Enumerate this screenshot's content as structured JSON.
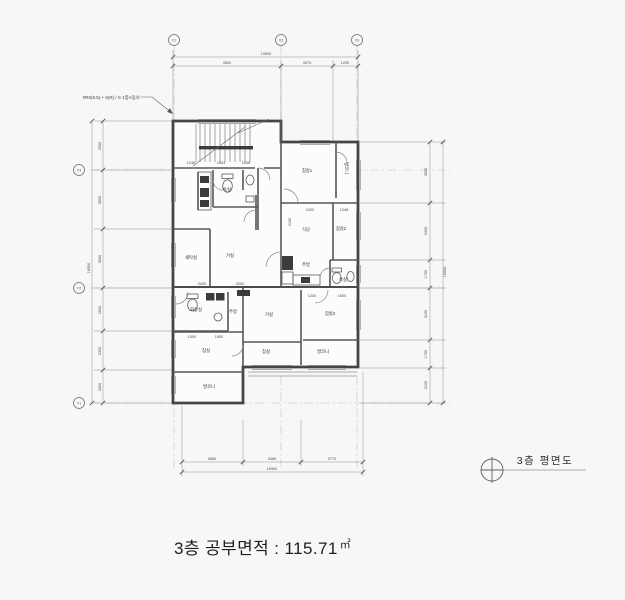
{
  "drawing": {
    "note": "#R6(8.5) + 6(R) / S 1종A동보",
    "plan_title": "3층 평면도",
    "caption_label": "3층 공부면적 : 115.71",
    "caption_unit": "㎡",
    "grid": {
      "x_axes": [
        {
          "label": "X1",
          "x": 174
        },
        {
          "label": "X2",
          "x": 281
        },
        {
          "label": "X3",
          "x": 357
        }
      ],
      "y_axes": [
        {
          "label": "Y3",
          "y": 170
        },
        {
          "label": "Y2",
          "y": 288
        },
        {
          "label": "Y1",
          "y": 403
        }
      ]
    },
    "room_labels": [
      {
        "t": "욕실",
        "x": 227,
        "y": 191
      },
      {
        "t": "침실1",
        "x": 307,
        "y": 172
      },
      {
        "t": "발코니",
        "x": 345,
        "y": 168,
        "v": 1
      },
      {
        "t": "세탁실",
        "x": 191,
        "y": 259
      },
      {
        "t": "거실",
        "x": 230,
        "y": 257
      },
      {
        "t": "식당",
        "x": 306,
        "y": 231
      },
      {
        "t": "침실2",
        "x": 341,
        "y": 230
      },
      {
        "t": "주방",
        "x": 306,
        "y": 266
      },
      {
        "t": "욕실",
        "x": 343,
        "y": 281
      },
      {
        "t": "화장실",
        "x": 196,
        "y": 311
      },
      {
        "t": "주방",
        "x": 233,
        "y": 313
      },
      {
        "t": "거실",
        "x": 269,
        "y": 316
      },
      {
        "t": "침실3",
        "x": 330,
        "y": 315
      },
      {
        "t": "침실",
        "x": 266,
        "y": 353
      },
      {
        "t": "발코니",
        "x": 323,
        "y": 353
      },
      {
        "t": "침실",
        "x": 206,
        "y": 352
      },
      {
        "t": "발코니",
        "x": 209,
        "y": 388
      }
    ],
    "dim_labels": [
      {
        "t": "10900",
        "x": 266,
        "y": 55
      },
      {
        "t": "4500",
        "x": 227,
        "y": 64
      },
      {
        "t": "4070",
        "x": 307,
        "y": 64
      },
      {
        "t": "1200",
        "x": 345,
        "y": 64
      },
      {
        "t": "3650",
        "x": 212,
        "y": 460
      },
      {
        "t": "3480",
        "x": 272,
        "y": 460
      },
      {
        "t": "3770",
        "x": 332,
        "y": 460
      },
      {
        "t": "10900",
        "x": 272,
        "y": 470
      },
      {
        "t": "16900",
        "x": 90,
        "y": 268,
        "r": 1
      },
      {
        "t": "2900",
        "x": 101,
        "y": 146,
        "r": 1
      },
      {
        "t": "3500",
        "x": 101,
        "y": 200,
        "r": 1
      },
      {
        "t": "3500",
        "x": 101,
        "y": 259,
        "r": 1
      },
      {
        "t": "2600",
        "x": 101,
        "y": 310,
        "r": 1
      },
      {
        "t": "2300",
        "x": 101,
        "y": 351,
        "r": 1
      },
      {
        "t": "2000",
        "x": 101,
        "y": 387,
        "r": 1
      },
      {
        "t": "15600",
        "x": 446,
        "y": 272,
        "r": 1
      },
      {
        "t": "3650",
        "x": 427,
        "y": 172,
        "r": 1
      },
      {
        "t": "3400",
        "x": 427,
        "y": 231,
        "r": 1
      },
      {
        "t": "1700",
        "x": 427,
        "y": 274,
        "r": 1
      },
      {
        "t": "3100",
        "x": 427,
        "y": 314,
        "r": 1
      },
      {
        "t": "1700",
        "x": 427,
        "y": 354,
        "r": 1
      },
      {
        "t": "2100",
        "x": 427,
        "y": 385,
        "r": 1
      },
      {
        "t": "1248",
        "x": 191,
        "y": 164
      },
      {
        "t": "1803",
        "x": 221,
        "y": 164
      },
      {
        "t": "1508",
        "x": 246,
        "y": 164
      },
      {
        "t": "2400",
        "x": 310,
        "y": 211
      },
      {
        "t": "1248",
        "x": 344,
        "y": 211
      },
      {
        "t": "2400",
        "x": 202,
        "y": 285
      },
      {
        "t": "3200",
        "x": 240,
        "y": 285
      },
      {
        "t": "1200",
        "x": 312,
        "y": 297
      },
      {
        "t": "1500",
        "x": 342,
        "y": 297
      },
      {
        "t": "1500",
        "x": 192,
        "y": 338
      },
      {
        "t": "1800",
        "x": 219,
        "y": 338
      },
      {
        "t": "2100",
        "x": 291,
        "y": 222,
        "r": 1
      }
    ]
  }
}
